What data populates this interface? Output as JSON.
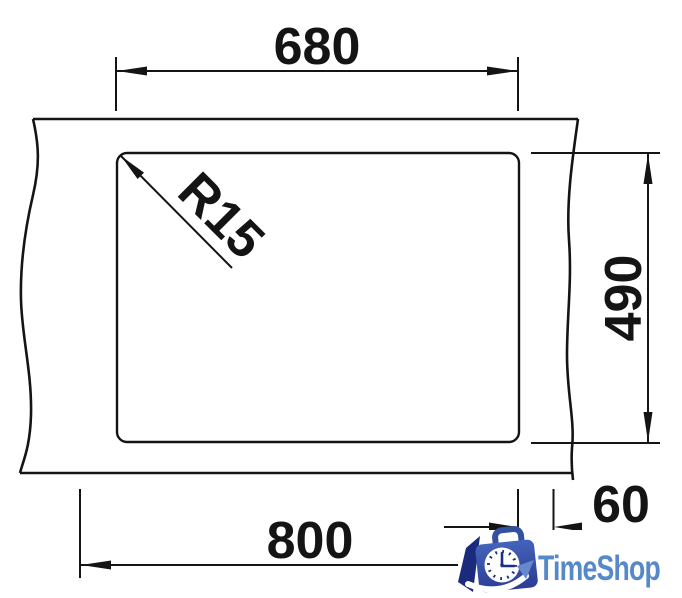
{
  "dimensions": {
    "top_width": "680",
    "right_height": "490",
    "bottom_width": "800",
    "edge_offset": "60",
    "corner_radius": "R15"
  },
  "logo": {
    "text": "TimeShop",
    "text_color": "#5689c9",
    "bag_blue": "#3a57b0",
    "bag_dark": "#1c2a7e",
    "clock_mark_color": "#1e2f85"
  },
  "colors": {
    "line": "#141414",
    "background": "#ffffff"
  }
}
